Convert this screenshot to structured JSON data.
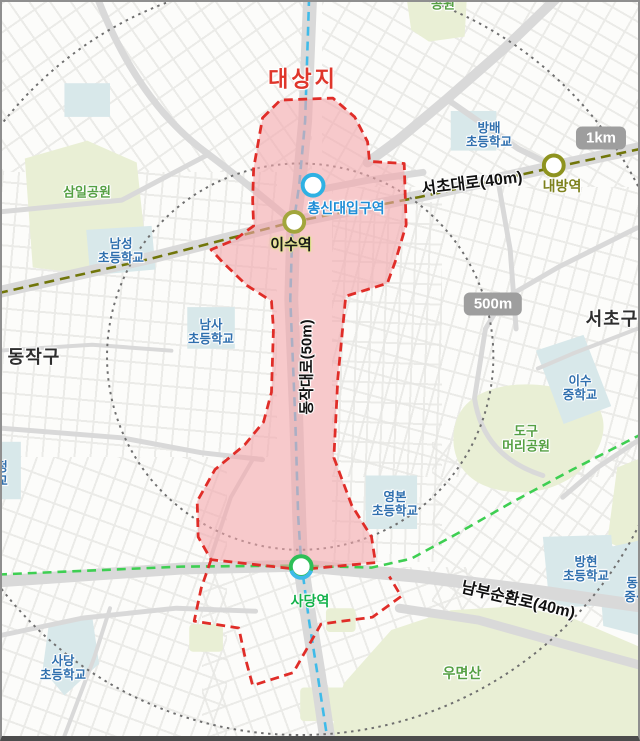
{
  "site": {
    "label": "대상지",
    "boundary_color": "#e02d28",
    "fill_color": "#f3a6ab"
  },
  "districts": [
    {
      "name": "동작구"
    },
    {
      "name": "서초구"
    }
  ],
  "roads": [
    {
      "name": "서초대로(40m)"
    },
    {
      "name": "동작대로(50m)"
    },
    {
      "name": "남부순환로(40m)"
    }
  ],
  "stations": [
    {
      "name": "총신대입구역",
      "marker_color": "#2fb1e3",
      "label_color": "#1f8dd6"
    },
    {
      "name": "이수역",
      "marker_color": "#a2a63c",
      "label_color": "#1a1a1a"
    },
    {
      "name": "내방역",
      "marker_color": "#8e931f",
      "label_color": "#7d811c"
    },
    {
      "name": "사당역",
      "marker_color": "#2ebf57",
      "label_color": "#12b14a"
    }
  ],
  "subway_lines": [
    {
      "name": "line-4-blue",
      "color": "#3fbbe9"
    },
    {
      "name": "line-7-olive",
      "color": "#71760a"
    },
    {
      "name": "line-2-green",
      "color": "#3ecf52"
    }
  ],
  "scale_markers": [
    {
      "label": "1km"
    },
    {
      "label": "500m"
    }
  ],
  "schools": [
    {
      "lines": [
        "방배",
        "초등학교"
      ]
    },
    {
      "lines": [
        "남성",
        "초등학교"
      ]
    },
    {
      "lines": [
        "남사",
        "초등학교"
      ]
    },
    {
      "lines": [
        "이수",
        "중학교"
      ]
    },
    {
      "lines": [
        "영본",
        "초등학교"
      ]
    },
    {
      "lines": [
        "방현",
        "초등학교"
      ]
    },
    {
      "lines": [
        "사당",
        "초등학교"
      ]
    },
    {
      "lines": [
        "동덕",
        "중·고"
      ]
    },
    {
      "lines": [
        "정",
        "교"
      ]
    }
  ],
  "parks": [
    {
      "lines": [
        "삼일공원"
      ]
    },
    {
      "lines": [
        "도구",
        "머리공원"
      ]
    },
    {
      "lines": [
        "우면산"
      ]
    },
    {
      "lines": [
        "공원"
      ]
    }
  ]
}
